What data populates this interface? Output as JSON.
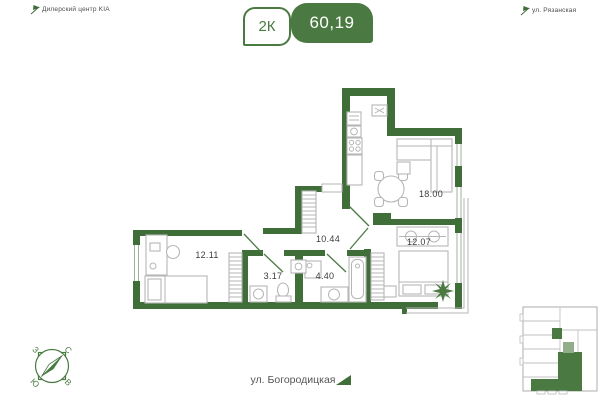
{
  "header": {
    "landmark_left": "Дилерский центр KIA",
    "landmark_right": "ул. Рязанская",
    "badge": {
      "rooms_label": "2К",
      "area_label": "60,19"
    }
  },
  "plan": {
    "rooms": [
      {
        "name": "kitchen-living-room",
        "area": "18.00"
      },
      {
        "name": "bedroom-right",
        "area": "12.07"
      },
      {
        "name": "hallway",
        "area": "10.44"
      },
      {
        "name": "bedroom-left",
        "area": "12.11"
      },
      {
        "name": "wc",
        "area": "3.17"
      },
      {
        "name": "bathroom",
        "area": "4.40"
      }
    ]
  },
  "compass": {
    "north": "С",
    "south": "Ю",
    "west": "З",
    "east": "В"
  },
  "footer": {
    "street": "ул. Богородицкая"
  },
  "colors": {
    "wall_green": "#3f6e38",
    "badge_green": "#4a7a42",
    "furniture_gray": "#b6b6b6"
  }
}
